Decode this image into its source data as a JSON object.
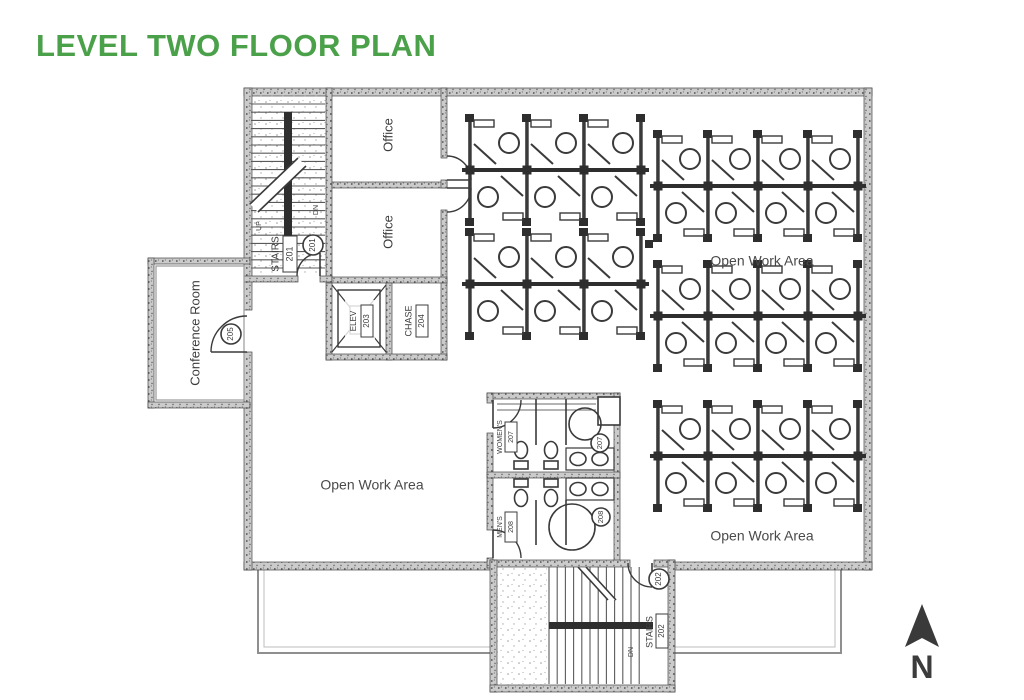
{
  "title": {
    "text": "LEVEL TWO FLOOR PLAN"
  },
  "colors": {
    "title_green": "#4BA04A",
    "ink": "#3C3C3C",
    "wall_gray": "#CBCBCB",
    "label_gray": "#4A4A4A"
  },
  "floorplan": {
    "rooms": {
      "stairs_201": {
        "label": "STAIRS",
        "number": "201"
      },
      "stairs_202": {
        "label": "STAIRS",
        "number": "202"
      },
      "elevator": {
        "label": "ELEV",
        "number": "203"
      },
      "chase": {
        "label": "CHASE",
        "number": "204"
      },
      "conference": {
        "label": "Conference Room"
      },
      "office_upper": {
        "label": "Office"
      },
      "office_lower": {
        "label": "Office"
      },
      "womens": {
        "label": "WOMEN'S",
        "number": "207"
      },
      "mens": {
        "label": "MEN'S",
        "number": "208"
      }
    },
    "open_work_areas": [
      "Open Work Area",
      "Open Work Area",
      "Open Work Area"
    ],
    "door_tags": {
      "stairs_201": "201",
      "conference": "205",
      "womens": "207",
      "mens": "208",
      "stairs_202": "202"
    },
    "stair_markers": {
      "up": "UP",
      "down": "DN"
    },
    "north_label": "N",
    "cubicle_clusters": [
      {
        "x": 470,
        "y": 118,
        "cols": 3,
        "colw": 57
      },
      {
        "x": 470,
        "y": 232,
        "cols": 3,
        "colw": 57
      },
      {
        "x": 658,
        "y": 134,
        "cols": 4,
        "colw": 50
      },
      {
        "x": 658,
        "y": 264,
        "cols": 4,
        "colw": 50
      },
      {
        "x": 658,
        "y": 404,
        "cols": 4,
        "colw": 50
      }
    ]
  }
}
